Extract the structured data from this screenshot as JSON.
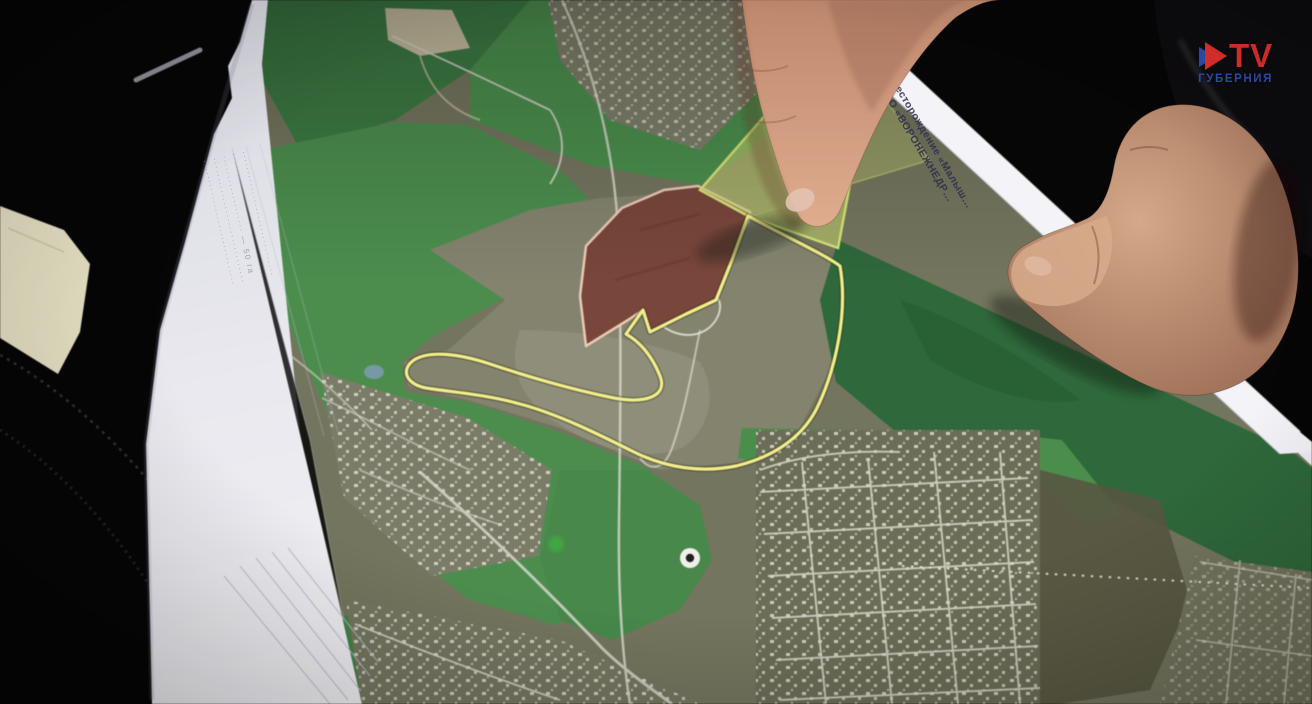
{
  "logo": {
    "icon": "play-icon",
    "text": "TV",
    "subtitle": "ГУБЕРНИЯ",
    "text_color": "#e2302c",
    "subtitle_color": "#2d4fae",
    "icon_colors": [
      "#2d4fae",
      "#e2302c"
    ]
  },
  "paper": {
    "edge_label_line1": "Месторождение «Малыш…",
    "edge_label_line2": "ООО «ВОРОНЕЖНЕДР…",
    "edge_label_color": "#2f2f4d",
    "margin_notes": [
      "·······························",
      "·······························",
      "··················· — 50 га",
      "·······························",
      "·······························"
    ]
  },
  "map": {
    "license_boundary_color": "#f2ee86",
    "quarry_fill": "#79463a",
    "quarry_border": "#eccab3",
    "highlight_parcel_fill": "#c8d56e",
    "forest_green": "#4b8e4d",
    "dark_forest_green": "#2e6839",
    "ground_olive": "#74755d",
    "road_color": "#d6d6c8",
    "marker": "point-marker"
  }
}
